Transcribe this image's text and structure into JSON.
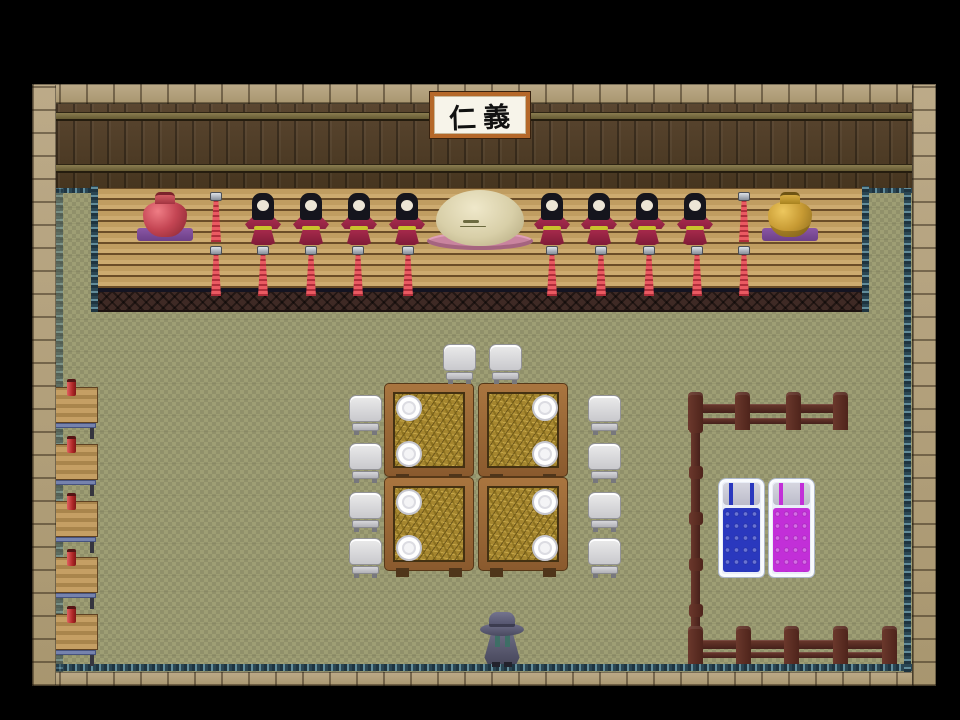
{
  "scene": {
    "name": "inn-common-room",
    "sign": {
      "text": "仁義"
    },
    "palette": {
      "background": "#000000",
      "stone_border": "#b2a07e",
      "wall_wood": "#53402b",
      "wall_beam": "#7e7248",
      "counter_wood": "#c9a76c",
      "counter_lattice": "#3f2a25",
      "floor_tatami": "#9a9a70",
      "trim_teal": "#2c4a57",
      "fence_wood": "#5c2d24",
      "doll_kimono": "#a52a4a",
      "doll_belt": "#c9c42c",
      "candle_red": "#d84a4a",
      "vase_left_red": "#c44553",
      "vase_right_gold": "#c79a33",
      "mat_purple": "#7b4b96",
      "sphere_cream": "#d8cfa8",
      "doily_pink": "#c9849f",
      "table_wood": "#9c6a35",
      "stool_gray": "#d9d9d9",
      "bed_blue": "#2a38be",
      "bed_magenta": "#c22fd8",
      "player_cloak": "#565669"
    },
    "counts": {
      "dolls": 8,
      "upper_candles": 2,
      "lower_candles": 10,
      "vases": 2,
      "tables": 4,
      "plates": 8,
      "stools": 10,
      "side_desks": 5,
      "beds": 2,
      "fence_top_posts": 4,
      "fence_bottom_posts": 5,
      "players": 1
    },
    "layout": {
      "dolls": [
        [
          263,
          193
        ],
        [
          311,
          193
        ],
        [
          359,
          193
        ],
        [
          407,
          193
        ],
        [
          552,
          193
        ],
        [
          599,
          193
        ],
        [
          647,
          193
        ],
        [
          695,
          193
        ]
      ],
      "candles_upper": [
        [
          216,
          192
        ],
        [
          744,
          192
        ]
      ],
      "candles_lower": [
        [
          216,
          246
        ],
        [
          263,
          246
        ],
        [
          311,
          246
        ],
        [
          358,
          246
        ],
        [
          408,
          246
        ],
        [
          552,
          246
        ],
        [
          601,
          246
        ],
        [
          649,
          246
        ],
        [
          697,
          246
        ],
        [
          744,
          246
        ]
      ],
      "vases": [
        {
          "x": 137,
          "y": 192,
          "type": "red"
        },
        {
          "x": 762,
          "y": 192,
          "type": "gold"
        }
      ],
      "tables": [
        {
          "x": 384,
          "y": 383,
          "plates": "left"
        },
        {
          "x": 478,
          "y": 383,
          "plates": "right"
        },
        {
          "x": 384,
          "y": 477,
          "plates": "left"
        },
        {
          "x": 478,
          "y": 477,
          "plates": "right"
        }
      ],
      "chairs": [
        [
          443,
          344
        ],
        [
          489,
          344
        ],
        [
          349,
          395
        ],
        [
          349,
          443
        ],
        [
          349,
          492
        ],
        [
          349,
          538
        ],
        [
          588,
          395
        ],
        [
          588,
          443
        ],
        [
          588,
          492
        ],
        [
          588,
          538
        ]
      ],
      "desks": [
        [
          46,
          383
        ],
        [
          46,
          440
        ],
        [
          46,
          497
        ],
        [
          46,
          553
        ],
        [
          46,
          610
        ]
      ],
      "beds": [
        {
          "x": 718,
          "y": 478,
          "color": "blue"
        },
        {
          "x": 768,
          "y": 478,
          "color": "magenta"
        }
      ],
      "fence_top_posts": [
        688,
        735,
        786,
        833
      ],
      "fence_bottom_posts": [
        688,
        736,
        784,
        833,
        882
      ],
      "fence_left_knobs": [
        420,
        466,
        512,
        558,
        604
      ]
    }
  }
}
